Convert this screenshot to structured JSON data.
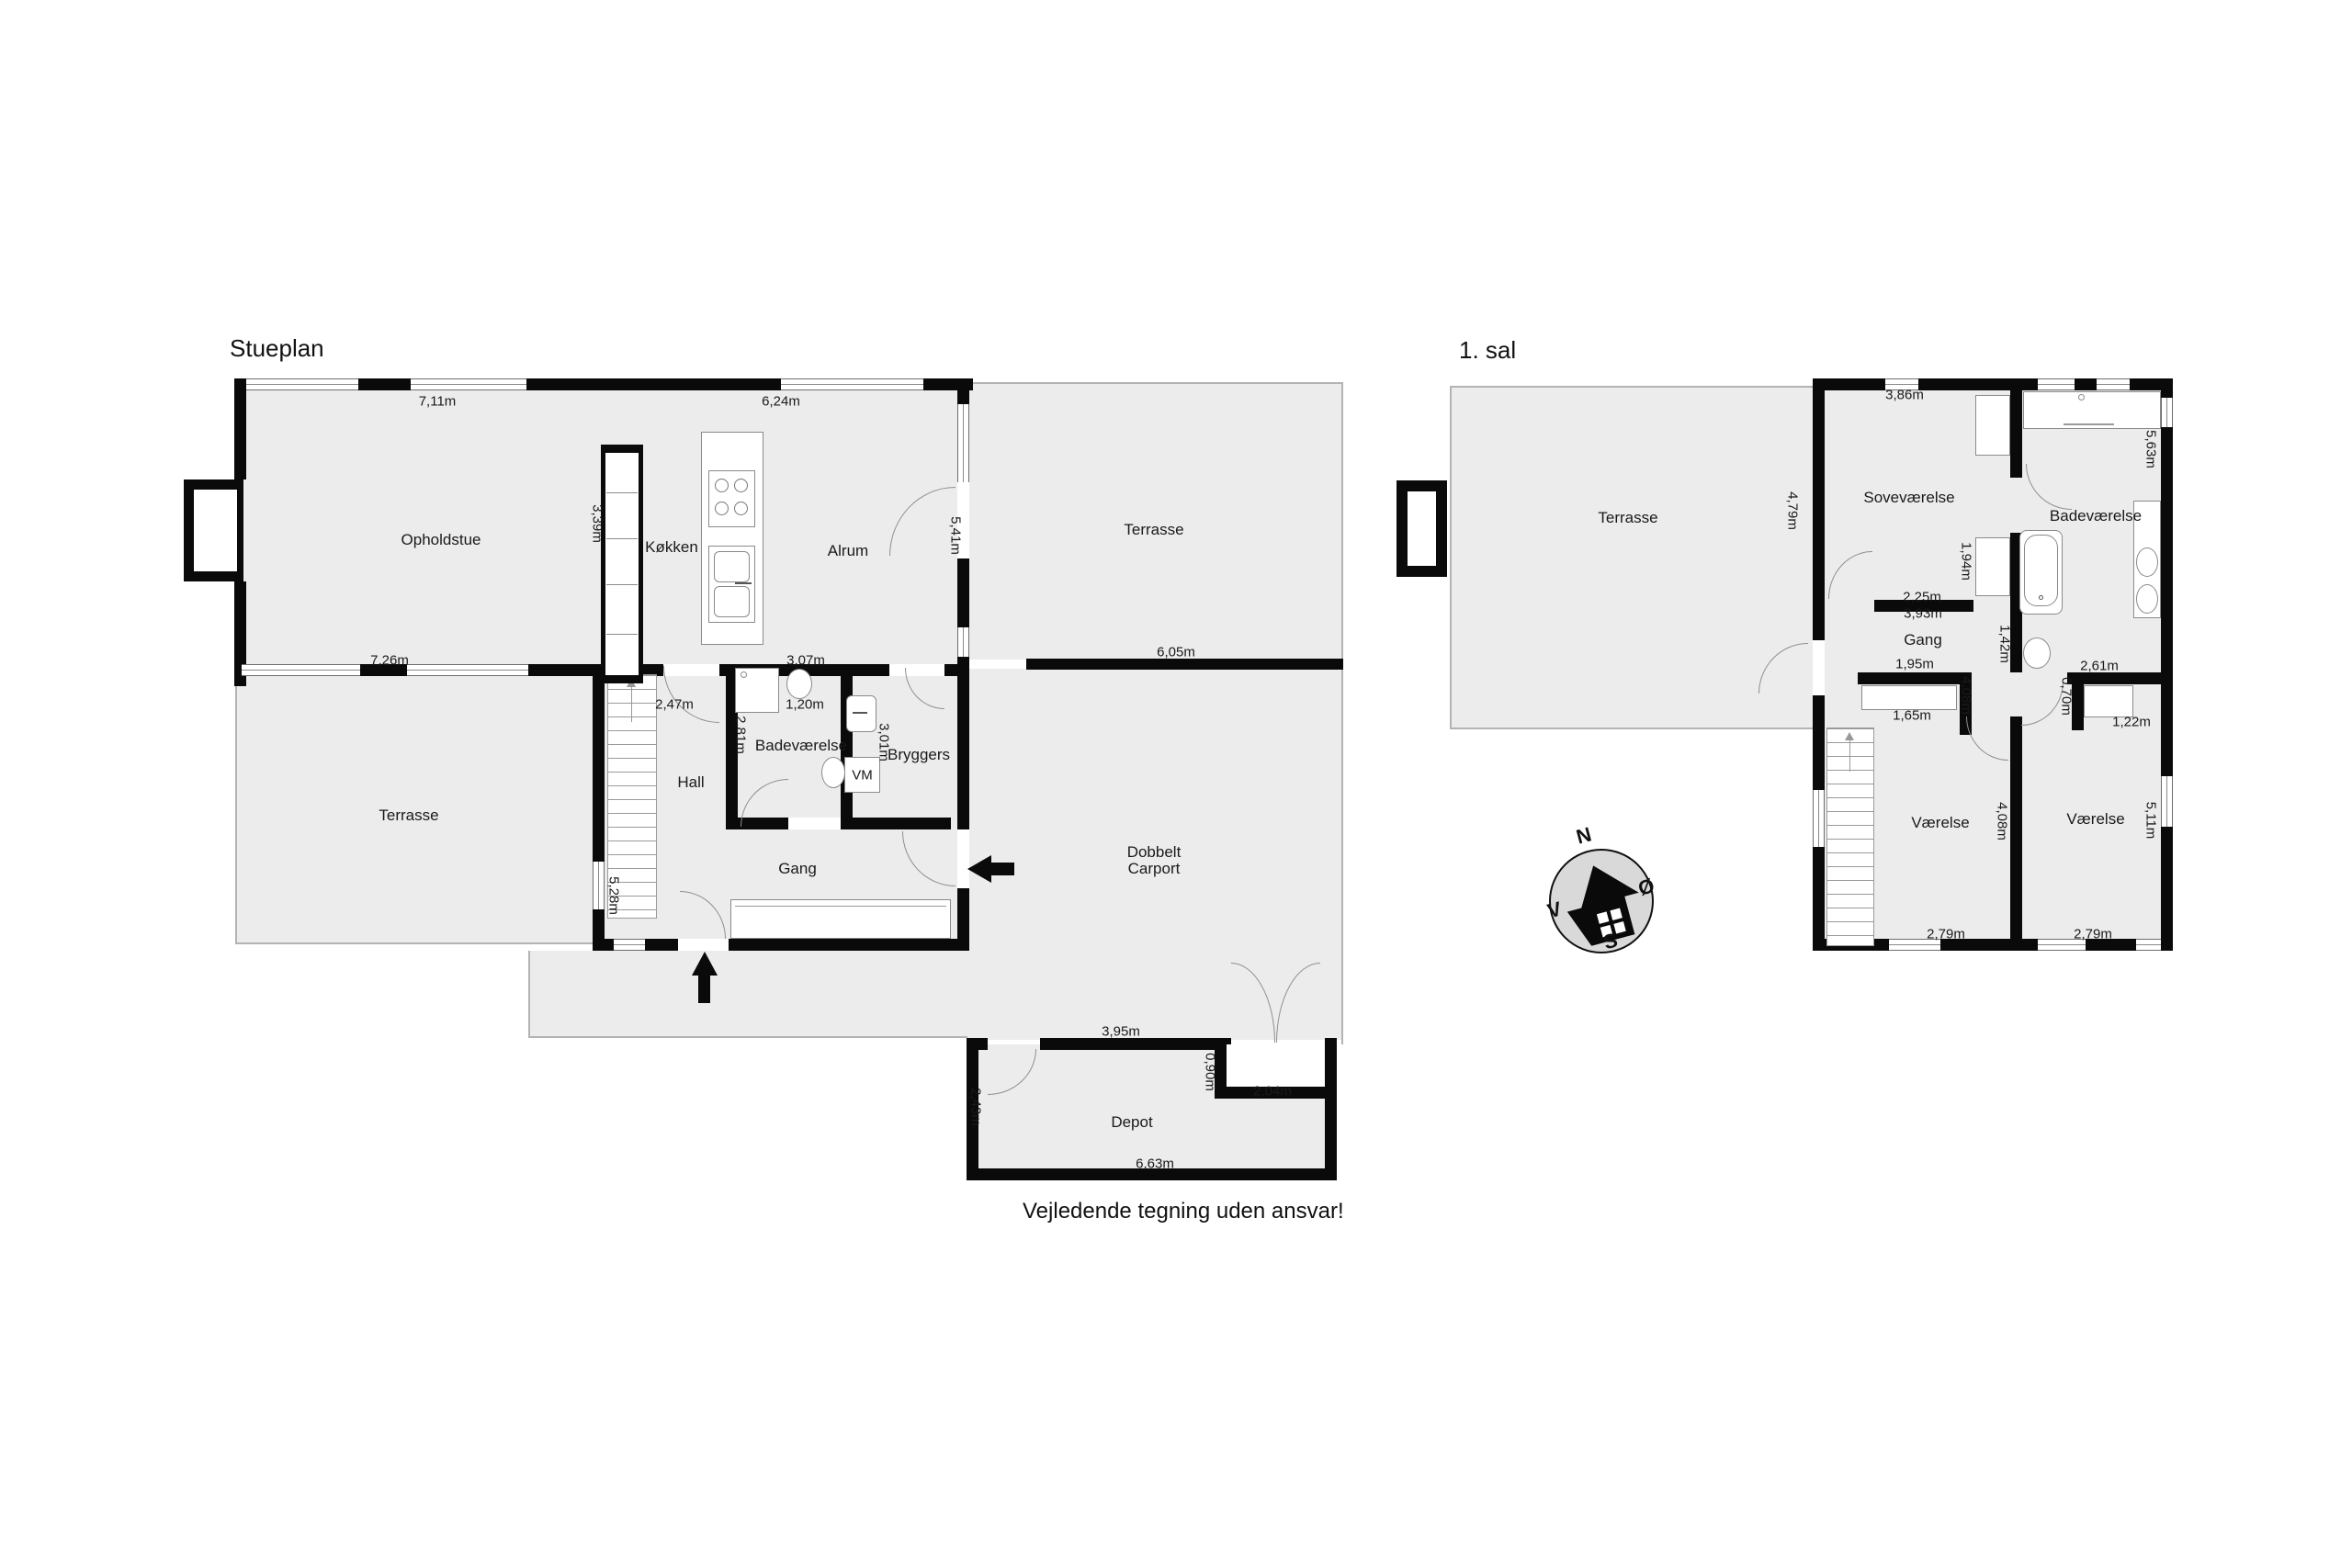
{
  "disclaimer": "Vejledende tegning uden ansvar!",
  "stueplan": {
    "title": "Stueplan",
    "labels": {
      "opholdstue": "Opholdstue",
      "kokken": "Køkken",
      "alrum": "Alrum",
      "terrasse_top": "Terrasse",
      "terrasse_left": "Terrasse",
      "hall": "Hall",
      "badevaerelse": "Badeværelse",
      "bryggers": "Bryggers",
      "vm": "VM",
      "gang": "Gang",
      "carport_line1": "Dobbelt",
      "carport_line2": "Carport",
      "depot": "Depot"
    },
    "meas": {
      "m711": "7,11m",
      "m624": "6,24m",
      "m339": "3,39m",
      "m541": "5,41m",
      "m726": "7,26m",
      "m307": "3,07m",
      "m247": "2,47m",
      "m120": "1,20m",
      "m281": "2,81m",
      "m301": "3,01m",
      "m528": "5,28m",
      "m605": "6,05m",
      "m395": "3,95m",
      "m090": "0,90m",
      "m204": "2,04m",
      "m243": "2,43m",
      "m663": "6,63m"
    }
  },
  "firstfloor": {
    "title": "1. sal",
    "labels": {
      "terrasse": "Terrasse",
      "sovevaerelse": "Soveværelse",
      "badevaerelse": "Badeværelse",
      "gang": "Gang",
      "vaerelse_left": "Værelse",
      "vaerelse_right": "Værelse"
    },
    "meas": {
      "m479": "4,79m",
      "m386": "3,86m",
      "m563": "5,63m",
      "m194": "1,94m",
      "m225": "2,25m",
      "m393": "3,93m",
      "m142": "1,42m",
      "m195": "1,95m",
      "m261": "2,61m",
      "m070": "0,70m",
      "m122": "1,22m",
      "m165": "1,65m",
      "m408a": "4,08m",
      "m408b": "4,08m",
      "m511": "5,11m",
      "m279a": "2,79m",
      "m279b": "2,79m"
    }
  },
  "compass": {
    "n": "N",
    "east": "Ø",
    "s": "S",
    "w": "V"
  }
}
